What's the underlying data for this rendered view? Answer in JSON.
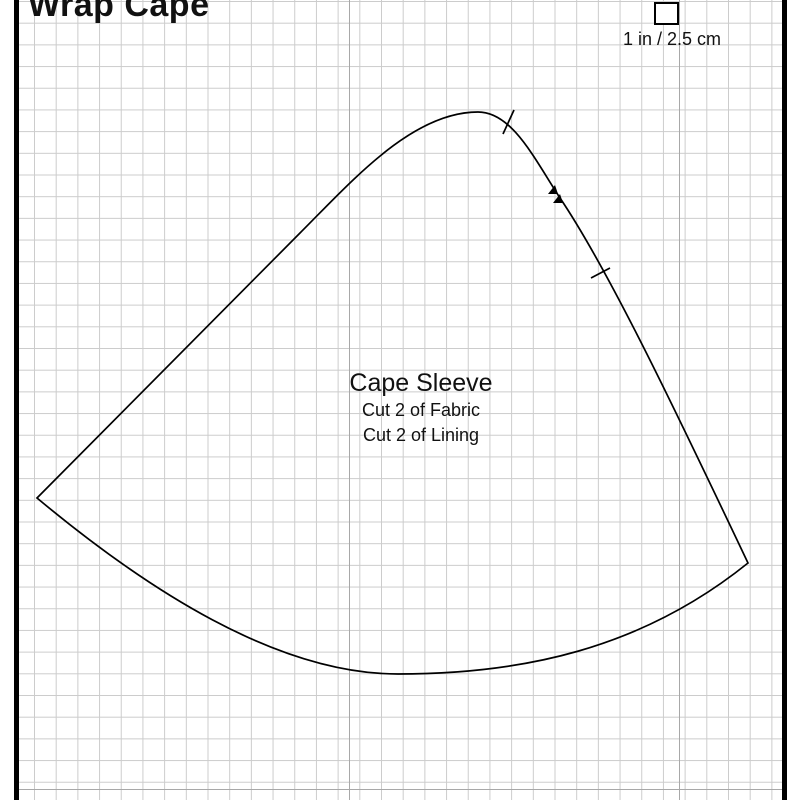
{
  "page": {
    "title": "Wrap Cape"
  },
  "scale_gauge": {
    "label": "1 in / 2.5 cm"
  },
  "pattern_piece": {
    "name": "Cape Sleeve",
    "cut_instructions": [
      "Cut 2 of Fabric",
      "Cut 2 of Lining"
    ]
  },
  "colors": {
    "paper": "#ffffff",
    "grid_minor": "#cccccc",
    "grid_major": "#a8a8a8",
    "frame": "#000000",
    "outline": "#000000",
    "text": "#111111"
  }
}
